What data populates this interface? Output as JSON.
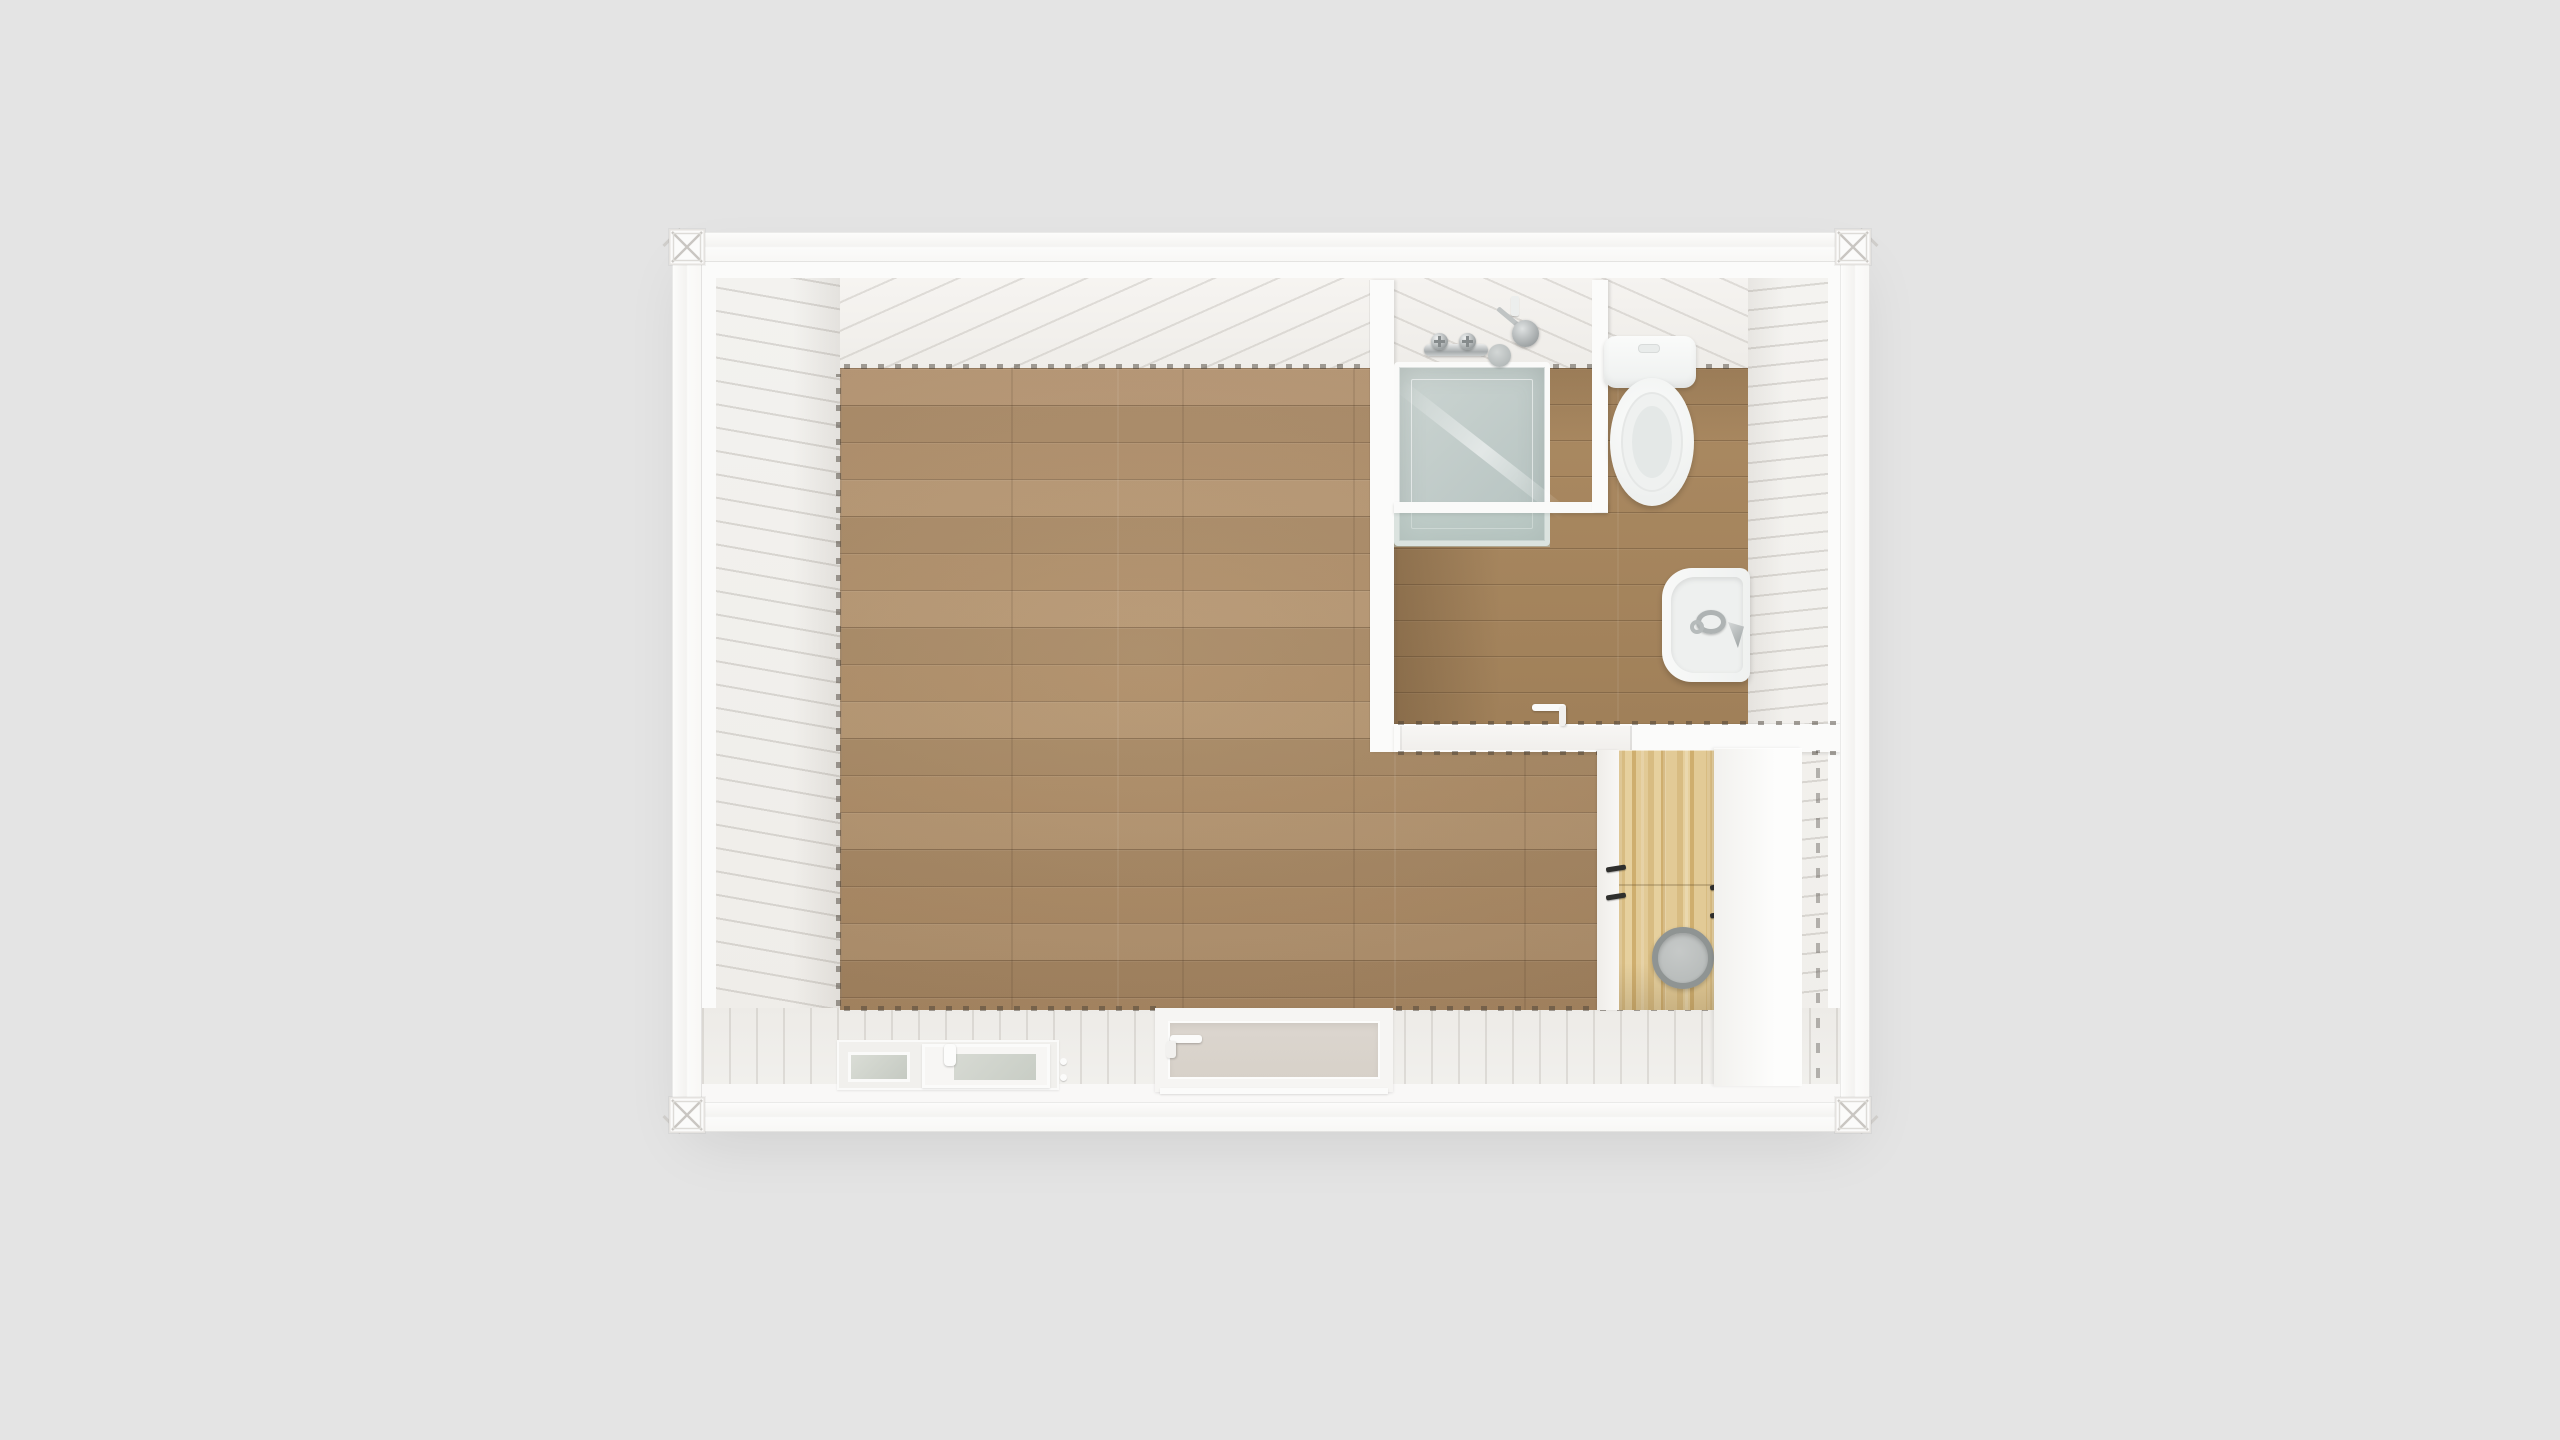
{
  "scene": {
    "kind": "top-down 3d rendering of a single-module container house",
    "rooms": [
      {
        "name": "main-room",
        "floor": "oak plank",
        "contents": []
      },
      {
        "name": "bathroom",
        "floor": "oak plank",
        "fixtures": [
          "shower-enclosure",
          "shower-mixer",
          "shower-head",
          "toilet",
          "wash-basin",
          "basin-faucet",
          "bathroom-door"
        ]
      },
      {
        "name": "laundry-nook",
        "fixtures": [
          "birch-cabinet",
          "washing-machine",
          "tall-white-cabinet",
          "cabinet-handles"
        ]
      }
    ],
    "openings": [
      {
        "name": "window",
        "wall": "bottom",
        "panes": 2,
        "handle": true
      },
      {
        "name": "entry-door",
        "wall": "bottom",
        "handle": true
      },
      {
        "name": "bathroom-door",
        "wall": "bathroom-bottom",
        "handle": true
      }
    ],
    "structure": [
      "container-frame-rails",
      "corner-castings-x4",
      "corrugated-white-walls",
      "ribbed-ceiling"
    ]
  },
  "colors": {
    "bg": "#e4e4e4",
    "frameWhite": "#fbfbfa",
    "wallWhite": "#f2f0ed",
    "wood": "#b2906b",
    "bathWood": "#a8875f",
    "glass": "#c7d1ce",
    "fixWhite": "#f7f8f7",
    "birch": "#dfc693",
    "washer": "#8f9493",
    "doorPanel": "#d7d1c9"
  }
}
